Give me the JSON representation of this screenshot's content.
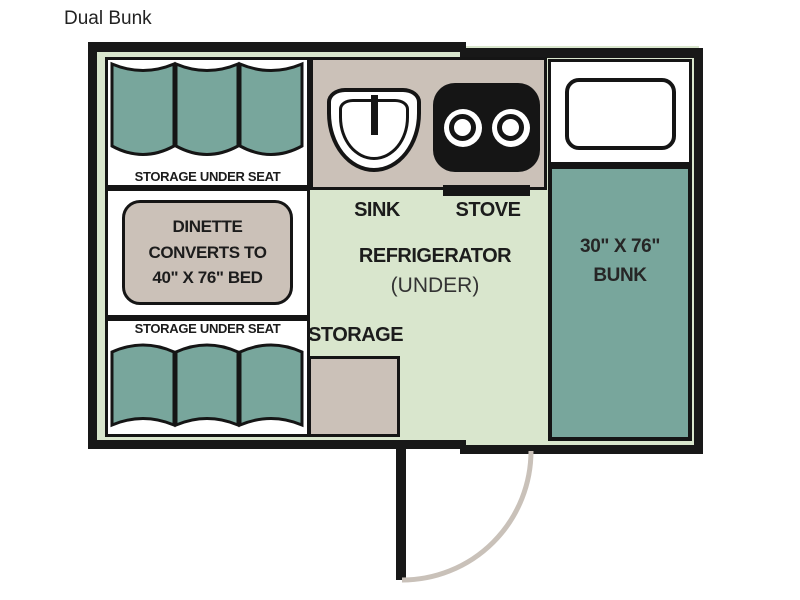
{
  "title": "Dual Bunk",
  "colors": {
    "wall": "#181818",
    "floor": "#d9e6cd",
    "cushion_teal": "#78a69c",
    "counter_tan": "#cbc1b8",
    "door_arc": "#c9c1b9"
  },
  "floorplan": {
    "seat_top": {
      "label": "STORAGE UNDER SEAT"
    },
    "seat_bottom": {
      "label": "STORAGE UNDER SEAT"
    },
    "dinette": {
      "line1": "DINETTE",
      "line2": "CONVERTS TO",
      "line3": "40\" X 76\" BED"
    },
    "kitchen": {
      "sink_label": "SINK",
      "stove_label": "STOVE",
      "refrigerator_label": "REFRIGERATOR",
      "refrigerator_sub": "(UNDER)",
      "storage_label": "STORAGE"
    },
    "bunk": {
      "line1": "30\" X 76\"",
      "line2": "BUNK"
    }
  }
}
